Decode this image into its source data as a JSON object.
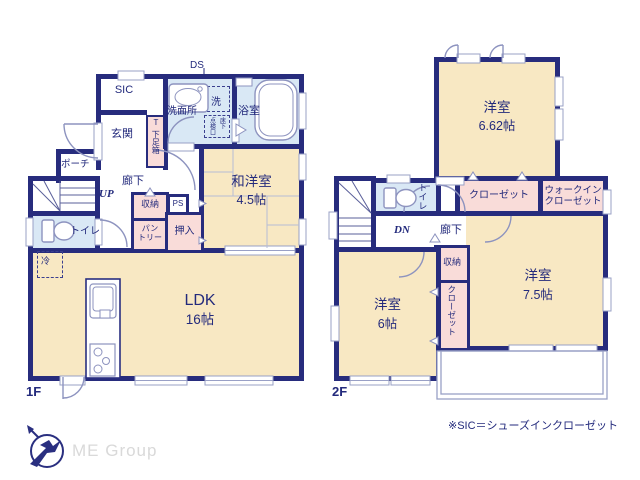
{
  "f1": {
    "floor_label": "1F",
    "ds": "DS",
    "sic": "SIC",
    "genkan": "玄関",
    "shoe_t": "T",
    "shoe_box": "下足箱",
    "washroom": "洗面所",
    "washer": "洗",
    "underfloor_r": "床下",
    "underfloor_l": "点検口",
    "bath": "浴室",
    "porch": "ポーチ",
    "hall": "廊下",
    "up": "UP",
    "toilet": "トイレ",
    "storage": "収納",
    "pantry_1": "パン",
    "pantry_2": "トリー",
    "ps": "PS",
    "oshiire": "押入",
    "washitsu": "和洋室",
    "washitsu_size": "4.5帖",
    "ldk": "LDK",
    "ldk_size": "16帖",
    "fridge": "冷"
  },
  "f2": {
    "floor_label": "2F",
    "room_a": "洋室",
    "room_a_size": "6.62帖",
    "closet": "クローゼット",
    "wic_1": "ウォークイン",
    "wic_2": "クローゼット",
    "toilet": "トイレ",
    "dn": "DN",
    "hall": "廊下",
    "storage": "収納",
    "closet_v": "クローゼット",
    "room_b": "洋室",
    "room_b_size": "7.5帖",
    "room_c": "洋室",
    "room_c_size": "6帖"
  },
  "footer": {
    "note": "※SIC＝シューズインクローゼット",
    "brand": "ME Group"
  },
  "colors": {
    "wall": "#272c7d",
    "room_tan": "#f8e8c3",
    "closet_pink": "#f9dcd9",
    "wet_blue": "#d9e8f5",
    "thin_line": "#8d93bf",
    "brand_gray": "#d9d9d9"
  }
}
